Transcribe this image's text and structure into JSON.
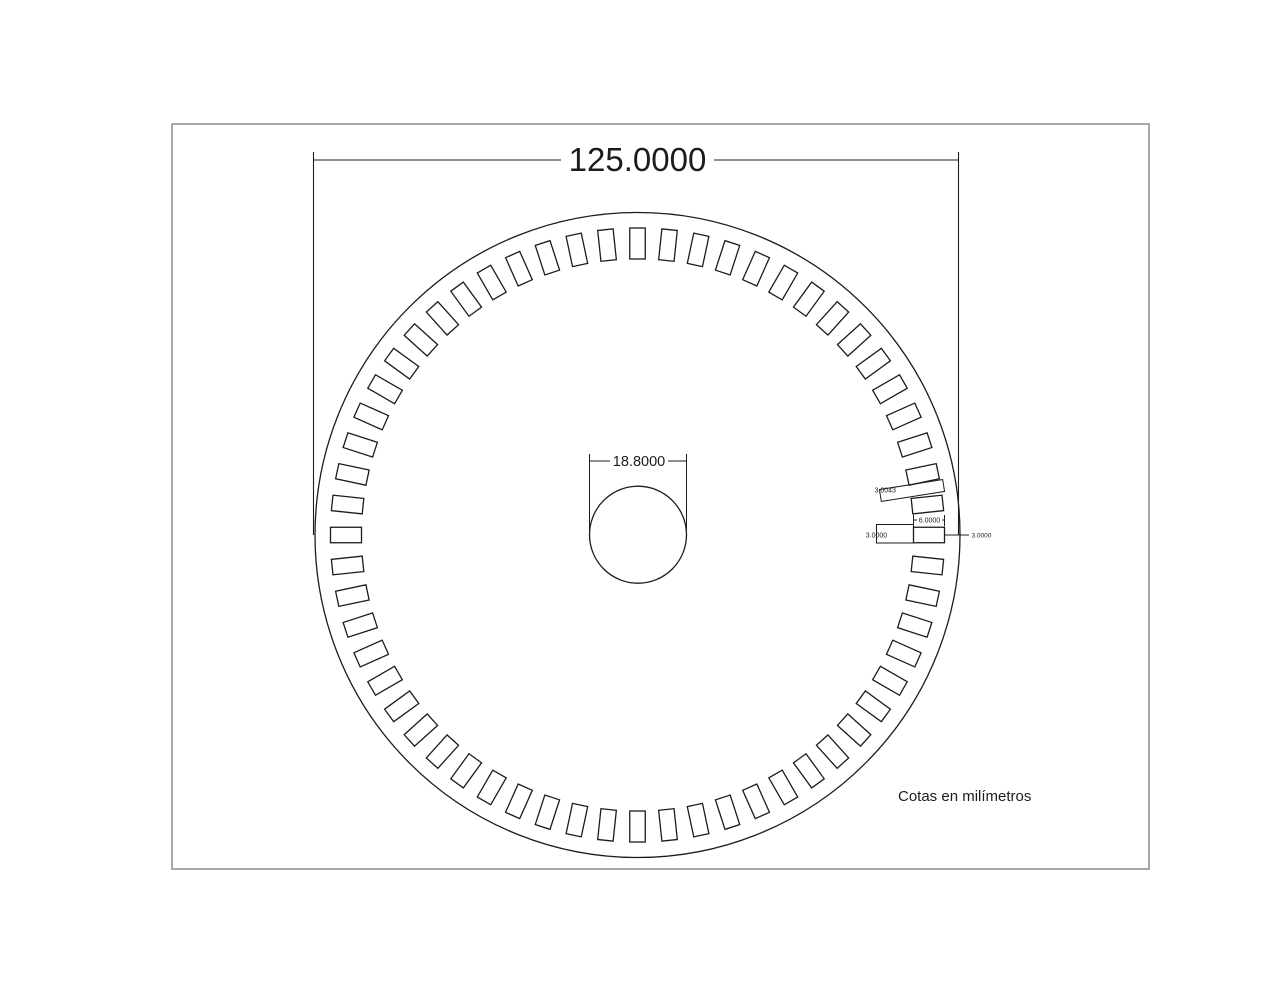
{
  "drawing": {
    "note": "Cotas en milímetros",
    "disc": {
      "outer_diameter_label": "125.0000",
      "hole_diameter_label": "18.8000",
      "slot_count": 60,
      "slot_angle_step_deg": 6
    },
    "slot_dimensions": {
      "length_label": "6.0000",
      "width_label": "3.0000",
      "outer_margin_label": "3.0000",
      "gap_label": "3.0043"
    },
    "colors": {
      "line": "#1c1c1c",
      "frame": "#9e9e9e",
      "background": "#ffffff"
    }
  }
}
